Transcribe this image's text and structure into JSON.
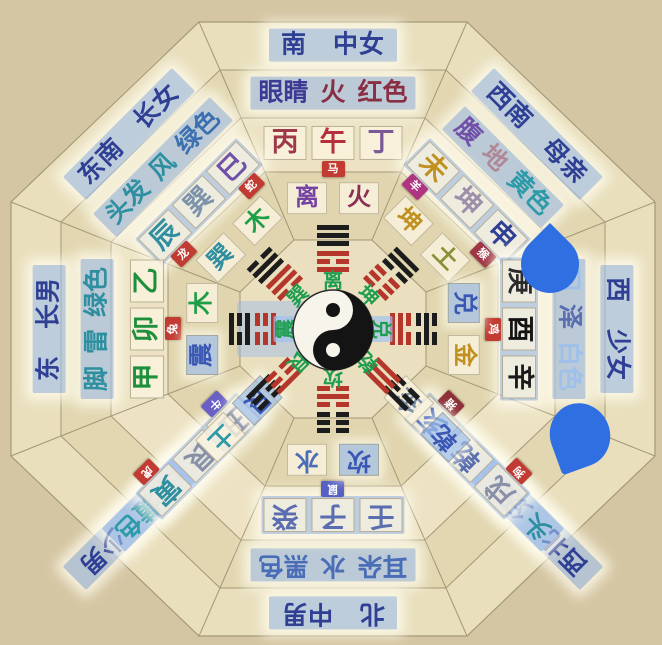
{
  "palette": {
    "background": "#d5c6a3",
    "band_outer": "#e9dfbd",
    "band_2": "#e2d7b1",
    "band_3": "#ede3c4",
    "band_4": "#e0d5ae",
    "band_inner": "#eae0bf",
    "line": "#a39877",
    "highlight": "#a3c2ee",
    "trigram_red": "#b5372b",
    "trigram_black": "#1c1c1c",
    "green_label": "#1f9e50",
    "marker_blue": "#2f6fe2",
    "taiji_white": "#f7f4ec",
    "taiji_black": "#141414"
  },
  "sectors": [
    {
      "id": "S",
      "name": "south",
      "direction": "南",
      "family": "中女",
      "attributes": [
        {
          "t": "眼睛",
          "c": "#3d3a95"
        },
        {
          "t": "火",
          "c": "#8a2e44"
        },
        {
          "t": "红色",
          "c": "#8a2e44"
        }
      ],
      "stems_hl": false,
      "stems": [
        {
          "t": "丙",
          "c": "#9d3948"
        },
        {
          "t": "午",
          "c": "#b5303c",
          "badge": {
            "t": "马",
            "c": "#c23b32"
          }
        },
        {
          "t": "丁",
          "c": "#7a5898"
        }
      ],
      "trigram": {
        "t": "离",
        "c": "#7443a4",
        "hl": false,
        "el": "火",
        "elc": "#8a3055"
      },
      "inner": {
        "label": "离",
        "hl": false,
        "black": "111",
        "red": "101"
      }
    },
    {
      "id": "SE",
      "name": "southeast",
      "direction": "东南",
      "family": "长女",
      "attributes": [
        {
          "t": "头发",
          "c": "#2d8fa0"
        },
        {
          "t": "风",
          "c": "#2d8fa0"
        },
        {
          "t": "绿色",
          "c": "#3a6fb0"
        }
      ],
      "stems_hl": true,
      "stems": [
        {
          "t": "辰",
          "c": "#2f8fa0",
          "badge": {
            "t": "龙",
            "c": "#c23b32"
          }
        },
        {
          "t": "巽",
          "c": "#7d93ab"
        },
        {
          "t": "巳",
          "c": "#6f51a8",
          "badge": {
            "t": "蛇",
            "c": "#c23b32"
          }
        }
      ],
      "trigram": {
        "t": "巽",
        "c": "#2f8fa0",
        "hl": false,
        "el": "木",
        "elc": "#1e9e46"
      },
      "inner": {
        "label": "巽",
        "hl": false,
        "black": "011",
        "red": "110"
      }
    },
    {
      "id": "SW",
      "name": "southwest",
      "direction": "西南",
      "family": "母亲",
      "attributes": [
        {
          "t": "腹",
          "c": "#7050a8"
        },
        {
          "t": "地",
          "c": "#b08898"
        },
        {
          "t": "黄色",
          "c": "#2d9aa8"
        }
      ],
      "stems_hl": true,
      "stems": [
        {
          "t": "未",
          "c": "#c09020",
          "badge": {
            "t": "羊",
            "c": "#b03580"
          }
        },
        {
          "t": "坤",
          "c": "#9b8fa9"
        },
        {
          "t": "申",
          "c": "#2e3f94",
          "badge": {
            "t": "猴",
            "c": "#a03545"
          }
        }
      ],
      "trigram": {
        "t": "坤",
        "c": "#c09020",
        "hl": false,
        "el": "土",
        "elc": "#8a8f3a"
      },
      "inner": {
        "label": "坤",
        "hl": false,
        "black": "110",
        "red": "000"
      }
    },
    {
      "id": "E",
      "name": "east",
      "direction": "东",
      "family": "长男",
      "attributes": [
        {
          "t": "脚",
          "c": "#2d8fa0"
        },
        {
          "t": "雷",
          "c": "#2d8fa0"
        },
        {
          "t": "绿色",
          "c": "#2d8fa0"
        }
      ],
      "stems_hl": false,
      "stems": [
        {
          "t": "甲",
          "c": "#1e8f3c"
        },
        {
          "t": "卯",
          "c": "#1e8f3c",
          "badge": {
            "t": "兔",
            "c": "#c23b32"
          }
        },
        {
          "t": "乙",
          "c": "#1e8f3c"
        }
      ],
      "trigram": {
        "t": "震",
        "c": "#3a57b4",
        "hl": true,
        "el": "木",
        "elc": "#1e9e46"
      },
      "inner": {
        "label": "震",
        "hl": true,
        "black": "101",
        "red": "001"
      }
    },
    {
      "id": "W",
      "name": "west",
      "direction": "西",
      "family": "少女",
      "attributes": [
        {
          "t": "口",
          "c": "#9fc0ea"
        },
        {
          "t": "泽",
          "c": "#5a6db0"
        },
        {
          "t": "白色",
          "c": "#9fc0ea"
        }
      ],
      "stems_hl": true,
      "stems": [
        {
          "t": "庚",
          "c": "#2b2b2b"
        },
        {
          "t": "酉",
          "c": "#141414",
          "badge": {
            "t": "鸡",
            "c": "#c23b32"
          }
        },
        {
          "t": "辛",
          "c": "#1a1a1a"
        }
      ],
      "trigram": {
        "t": "兑",
        "c": "#3a57b4",
        "hl": true,
        "el": "金",
        "elc": "#c09020"
      },
      "inner": {
        "label": "兑",
        "hl": true,
        "black": "010",
        "red": "011"
      }
    },
    {
      "id": "N",
      "name": "north",
      "direction": "北",
      "family": "中男",
      "attributes": [
        {
          "t": "耳朵",
          "c": "#4a6db8"
        },
        {
          "t": "水",
          "c": "#4a6db8"
        },
        {
          "t": "黑色",
          "c": "#4a6db8"
        }
      ],
      "stems_hl": true,
      "stems": [
        {
          "t": "壬",
          "c": "#5a6db0"
        },
        {
          "t": "子",
          "c": "#5a6db0",
          "badge": {
            "t": "鼠",
            "c": "#5560c5"
          }
        },
        {
          "t": "癸",
          "c": "#5a6db0"
        }
      ],
      "trigram": {
        "t": "坎",
        "c": "#3a57b4",
        "hl": true,
        "el": "水",
        "elc": "#4a6db8"
      },
      "inner": {
        "label": "坎",
        "hl": false,
        "black": "000",
        "red": "010"
      }
    },
    {
      "id": "NE",
      "name": "northeast",
      "direction": "东北",
      "family": "少男",
      "attributes": [
        {
          "t": "手",
          "c": "#2d8fa0"
        },
        {
          "t": "山",
          "c": "#8a8fa8"
        },
        {
          "t": "黄色",
          "c": "#2d9aa8"
        }
      ],
      "stems_hl": true,
      "stems": [
        {
          "t": "丑",
          "c": "#8a8fa8",
          "badge": {
            "t": "牛",
            "c": "#6a5fc5"
          }
        },
        {
          "t": "艮",
          "c": "#8a8fa8"
        },
        {
          "t": "寅",
          "c": "#2d8fa0",
          "badge": {
            "t": "虎",
            "c": "#c23b32"
          }
        }
      ],
      "trigram": {
        "t": "艮",
        "c": "#3a57b4",
        "hl": true,
        "el": "土",
        "elc": "#2d9aa8"
      },
      "inner": {
        "label": "艮",
        "hl": false,
        "black": "001",
        "red": "100"
      }
    },
    {
      "id": "NW",
      "name": "northwest",
      "direction": "西北",
      "family": "父亲",
      "attributes": [
        {
          "t": "头",
          "c": "#2d8fa0"
        },
        {
          "t": "天",
          "c": "#4a6db8"
        },
        {
          "t": "白色",
          "c": "#9fc0ea"
        }
      ],
      "stems_hl": true,
      "stems": [
        {
          "t": "戌",
          "c": "#8a8fa8",
          "badge": {
            "t": "狗",
            "c": "#c23b32"
          }
        },
        {
          "t": "乾",
          "c": "#5a6db0"
        },
        {
          "t": "亥",
          "c": "#4a6db8",
          "badge": {
            "t": "猪",
            "c": "#8f3038"
          }
        }
      ],
      "trigram": {
        "t": "乾",
        "c": "#3a57b4",
        "hl": true,
        "el": "金",
        "elc": "#7a8fa8"
      },
      "inner": {
        "label": "乾",
        "hl": false,
        "black": "100",
        "red": "111"
      }
    }
  ],
  "markers": [
    {
      "shape": "teardrop-point-up",
      "color": "#2f6fe2"
    },
    {
      "shape": "teardrop-point-down",
      "color": "#2f6fe2"
    }
  ]
}
